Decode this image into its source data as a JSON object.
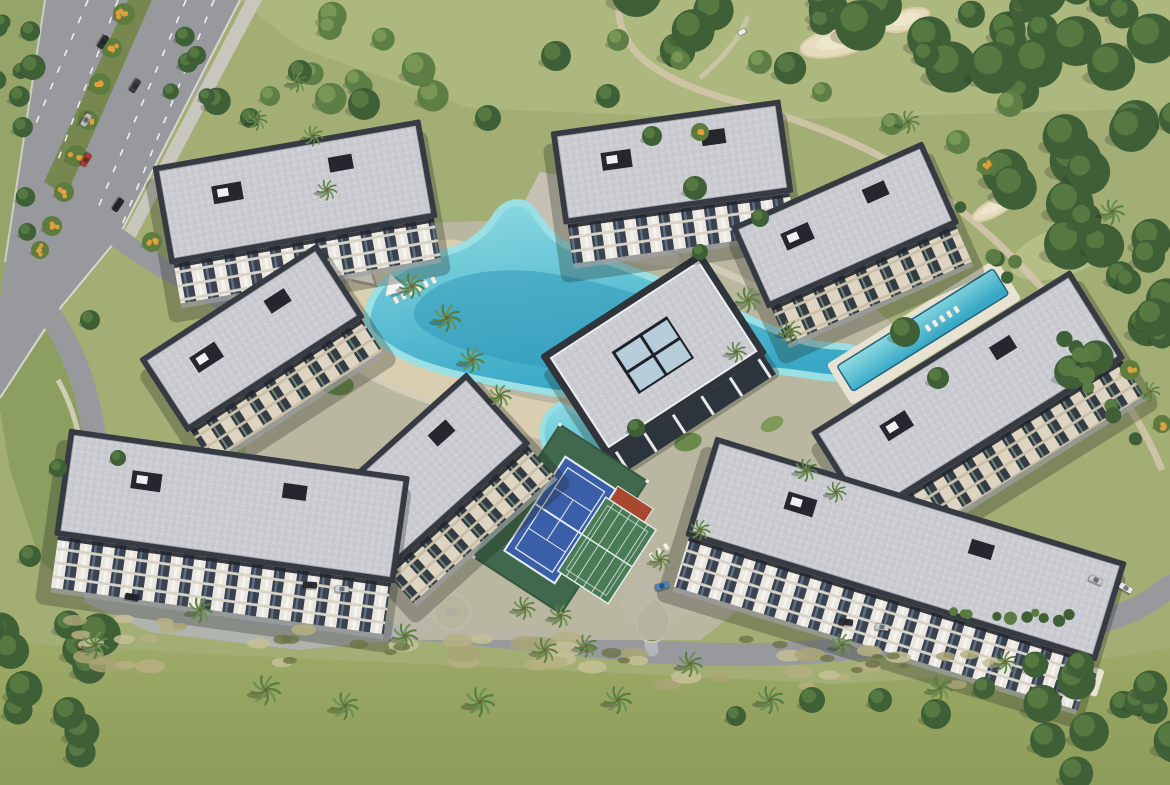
{
  "meta": {
    "title": "Aerial render of a residential apartment complex with lagoon pool, clubhouse, tennis courts and surrounding golf course",
    "view": "aerial-drone",
    "setting": "gated residential masterplan beside golf fairways and a tree-lined avenue"
  },
  "palette": {
    "base": "#a3ae75",
    "golfLight": "#adb87e",
    "fairway1": "#9daa68",
    "fairway2": "#8c9c59",
    "verge": "#95a468",
    "garden": "#8d9f60",
    "islandGreen": "#76904f",
    "forest1": "#3f5f36",
    "forest2": "#66884a",
    "treeLight1": "#5d7f46",
    "treeLight2": "#8aa75e",
    "palm1": "#6c9153",
    "palm2": "#597e42",
    "flowerGreen": "#5e7c3e",
    "flowerOrange": "#e2a13c",
    "rough1": "#b6b081",
    "rough2": "#c6c095",
    "rough3": "#a9a475",
    "scrub": "#6e7246",
    "asphalt": "#97999d",
    "roadLight": "#b3b5b9",
    "pavement": "#c6c1b2",
    "sidewalk": "#c9c6bd",
    "pathBeige": "#cfc5a9",
    "curb": "#e3e3df",
    "median": "#76874f",
    "parapet": "#363a42",
    "parapetDark": "#24272d",
    "gravel1": "#cbccd1",
    "gravel2": "#bdbfc5",
    "gravel3": "#d7d8db",
    "facadeLight": "#ebe8e1",
    "facadeCream": "#ddd4c2",
    "glassDark": "#3a4250",
    "slab": "#d8d2c6",
    "poolLight": "#8fdce2",
    "poolMid": "#38a8c6",
    "poolDeep": "#2e95b8",
    "poolRim": "#9adfe3",
    "poolEdge": "#23657f",
    "beach": "#dbcfb2",
    "deck": "#e8e2d2",
    "courtBlue": "#3b5ea8",
    "courtGreen": "#3f684d",
    "padelGreen": "#497b55",
    "courtRed": "#a8492f",
    "lineWhite": "#e6ebef",
    "skylight": "#b7cdd9",
    "stream": "#a6a793",
    "sand1": "#e6dcbd",
    "sand2": "#d9cda8",
    "shadow": "#1e2319",
    "white": "#f2efe6"
  },
  "scene": {
    "buildings": [
      {
        "id": "top-left",
        "cx": 295,
        "cy": 192,
        "w": 272,
        "h": 100,
        "rot": -10,
        "facade": "A",
        "fh": 40
      },
      {
        "id": "left",
        "cx": 252,
        "cy": 338,
        "w": 212,
        "h": 88,
        "rot": -33,
        "facade": "B",
        "fh": 38
      },
      {
        "id": "top-center",
        "cx": 672,
        "cy": 162,
        "w": 232,
        "h": 94,
        "rot": -8,
        "facade": "A",
        "fh": 40
      },
      {
        "id": "top-right",
        "cx": 845,
        "cy": 225,
        "w": 210,
        "h": 90,
        "rot": -24,
        "facade": "B",
        "fh": 40
      },
      {
        "id": "right",
        "cx": 968,
        "cy": 395,
        "w": 306,
        "h": 104,
        "rot": -32,
        "facade": "B",
        "fh": 42
      },
      {
        "id": "bottom-right",
        "cx": 906,
        "cy": 549,
        "w": 430,
        "h": 104,
        "rot": 17,
        "facade": "A",
        "fh": 52
      },
      {
        "id": "bottom-left",
        "cx": 232,
        "cy": 506,
        "w": 344,
        "h": 108,
        "rot": 8,
        "facade": "A",
        "fh": 52
      },
      {
        "id": "bottom-left-wing",
        "cx": 425,
        "cy": 474,
        "w": 198,
        "h": 96,
        "rot": -42,
        "facade": "B",
        "fh": 40
      }
    ],
    "forestClusters": [
      {
        "cx": 900,
        "cy": 28,
        "rx": 270,
        "ry": 42,
        "n": 26,
        "rmin": 13,
        "rmax": 26,
        "type": "forest",
        "seed": 7
      },
      {
        "cx": 1085,
        "cy": 165,
        "rx": 95,
        "ry": 115,
        "n": 18,
        "rmin": 15,
        "rmax": 28,
        "type": "forest",
        "seed": 11
      },
      {
        "cx": 1122,
        "cy": 330,
        "rx": 60,
        "ry": 80,
        "n": 10,
        "rmin": 12,
        "rmax": 22,
        "type": "forest",
        "seed": 3
      },
      {
        "cx": 1048,
        "cy": 322,
        "rx": 150,
        "ry": 10,
        "rot": 55,
        "n": 16,
        "rmin": 5,
        "rmax": 9,
        "type": "hedge",
        "seed": 5
      },
      {
        "cx": 1005,
        "cy": 612,
        "rx": 85,
        "ry": 7,
        "rot": 6,
        "n": 10,
        "rmin": 4,
        "rmax": 7,
        "type": "hedge",
        "seed": 9
      },
      {
        "cx": 1112,
        "cy": 722,
        "rx": 85,
        "ry": 62,
        "n": 12,
        "rmin": 13,
        "rmax": 24,
        "type": "forest",
        "seed": 13
      },
      {
        "cx": 52,
        "cy": 702,
        "rx": 78,
        "ry": 85,
        "n": 12,
        "rmin": 12,
        "rmax": 22,
        "type": "forest",
        "seed": 17
      },
      {
        "cx": 16,
        "cy": 120,
        "rx": 22,
        "ry": 115,
        "n": 10,
        "rmin": 7,
        "rmax": 13,
        "type": "forest",
        "seed": 19
      },
      {
        "cx": 430,
        "cy": 55,
        "rx": 120,
        "ry": 45,
        "n": 9,
        "rmin": 10,
        "rmax": 17,
        "type": "light",
        "seed": 23
      },
      {
        "cx": 208,
        "cy": 75,
        "rx": 40,
        "ry": 55,
        "n": 6,
        "rmin": 8,
        "rmax": 14,
        "type": "forest",
        "seed": 29
      },
      {
        "cx": 360,
        "cy": 648,
        "rx": 300,
        "ry": 20,
        "n": 26,
        "rmin": 8,
        "rmax": 18,
        "type": "rough",
        "seed": 31
      },
      {
        "cx": 800,
        "cy": 668,
        "rx": 205,
        "ry": 18,
        "n": 16,
        "rmin": 8,
        "rmax": 16,
        "type": "rough",
        "seed": 37
      },
      {
        "cx": 118,
        "cy": 628,
        "rx": 75,
        "ry": 16,
        "n": 8,
        "rmin": 7,
        "rmax": 14,
        "type": "rough",
        "seed": 41
      },
      {
        "cx": 520,
        "cy": 650,
        "rx": 260,
        "ry": 12,
        "n": 11,
        "rmin": 5,
        "rmax": 10,
        "type": "scrub",
        "seed": 43
      },
      {
        "cx": 862,
        "cy": 664,
        "rx": 120,
        "ry": 10,
        "n": 6,
        "rmin": 5,
        "rmax": 9,
        "type": "scrub",
        "seed": 47
      }
    ],
    "forestSingles": [
      [
        364,
        104,
        16
      ],
      [
        300,
        72,
        12
      ],
      [
        488,
        118,
        13
      ],
      [
        556,
        56,
        15
      ],
      [
        608,
        96,
        12
      ],
      [
        652,
        136,
        10
      ],
      [
        695,
        188,
        12
      ],
      [
        905,
        332,
        15
      ],
      [
        938,
        378,
        11
      ],
      [
        250,
        118,
        10
      ],
      [
        90,
        320,
        10
      ],
      [
        58,
        468,
        9
      ],
      [
        118,
        458,
        8
      ],
      [
        30,
        556,
        11
      ],
      [
        636,
        428,
        9
      ],
      [
        760,
        218,
        9
      ],
      [
        700,
        252,
        8
      ],
      [
        812,
        700,
        13
      ],
      [
        936,
        714,
        15
      ],
      [
        984,
        688,
        11
      ],
      [
        880,
        700,
        12
      ],
      [
        736,
        716,
        10
      ]
    ],
    "lightSingles": [
      [
        330,
        28,
        12
      ],
      [
        270,
        96,
        10
      ],
      [
        760,
        62,
        12
      ],
      [
        822,
        92,
        10
      ],
      [
        892,
        124,
        11
      ],
      [
        958,
        142,
        12
      ],
      [
        1010,
        104,
        13
      ],
      [
        618,
        40,
        11
      ],
      [
        680,
        60,
        10
      ]
    ],
    "palms": [
      [
        412,
        286,
        1.1
      ],
      [
        447,
        318,
        1.2
      ],
      [
        472,
        360,
        1.1
      ],
      [
        500,
        396,
        1.0
      ],
      [
        748,
        300,
        1.1
      ],
      [
        790,
        332,
        1.0
      ],
      [
        736,
        352,
        0.9
      ],
      [
        524,
        608,
        1.0
      ],
      [
        560,
        616,
        1.0
      ],
      [
        806,
        470,
        1.0
      ],
      [
        836,
        492,
        0.9
      ],
      [
        95,
        645,
        1.2
      ],
      [
        200,
        610,
        1.1
      ],
      [
        266,
        690,
        1.3
      ],
      [
        345,
        706,
        1.2
      ],
      [
        405,
        636,
        1.1
      ],
      [
        480,
        702,
        1.3
      ],
      [
        545,
        650,
        1.1
      ],
      [
        618,
        700,
        1.2
      ],
      [
        690,
        664,
        1.1
      ],
      [
        770,
        700,
        1.2
      ],
      [
        842,
        645,
        1.0
      ],
      [
        940,
        688,
        1.1
      ],
      [
        1005,
        662,
        1.0
      ],
      [
        297,
        82,
        0.9
      ],
      [
        313,
        136,
        0.9
      ],
      [
        327,
        190,
        0.9
      ],
      [
        257,
        120,
        0.9
      ],
      [
        908,
        122,
        1.0
      ],
      [
        1112,
        212,
        1.1
      ],
      [
        1150,
        392,
        0.9
      ],
      [
        700,
        530,
        0.9
      ],
      [
        660,
        560,
        0.9
      ],
      [
        586,
        646,
        1.0
      ]
    ],
    "flowering": [
      [
        124,
        14,
        11
      ],
      [
        112,
        48,
        10
      ],
      [
        100,
        84,
        11
      ],
      [
        88,
        120,
        10
      ],
      [
        76,
        156,
        11
      ],
      [
        64,
        192,
        10
      ],
      [
        52,
        226,
        10
      ],
      [
        152,
        242,
        10
      ],
      [
        986,
        166,
        9
      ],
      [
        1130,
        370,
        10
      ],
      [
        1162,
        424,
        9
      ],
      [
        700,
        132,
        9
      ],
      [
        40,
        250,
        9
      ]
    ],
    "bunkers": [
      {
        "x": 838,
        "y": 42,
        "rx": 38,
        "ry": 14,
        "rot": -12
      },
      {
        "x": 906,
        "y": 20,
        "rx": 24,
        "ry": 10,
        "rot": -18
      },
      {
        "x": 994,
        "y": 208,
        "rx": 24,
        "ry": 8,
        "rot": -28
      }
    ],
    "cars": [
      {
        "x": 103,
        "y": 42,
        "rot": 122,
        "c": "#2b2e33"
      },
      {
        "x": 86,
        "y": 120,
        "rot": 122,
        "c": "#b8babd"
      },
      {
        "x": 135,
        "y": 86,
        "rot": 122,
        "c": "#3a3d42"
      },
      {
        "x": 86,
        "y": 160,
        "rot": 122,
        "c": "#b03a32"
      },
      {
        "x": 118,
        "y": 205,
        "rot": 124,
        "c": "#23262b"
      },
      {
        "x": 310,
        "y": 585,
        "rot": 4,
        "c": "#2c2f34"
      },
      {
        "x": 342,
        "y": 589,
        "rot": 4,
        "c": "#cfd2d6"
      },
      {
        "x": 132,
        "y": 597,
        "rot": 10,
        "c": "#23262b"
      },
      {
        "x": 662,
        "y": 586,
        "rot": -15,
        "c": "#4f86c0"
      },
      {
        "x": 846,
        "y": 622,
        "rot": 7,
        "c": "#2c2f34"
      },
      {
        "x": 882,
        "y": 627,
        "rot": 7,
        "c": "#c9ccd0"
      },
      {
        "x": 1096,
        "y": 580,
        "rot": 24,
        "c": "#c6c9cd"
      },
      {
        "x": 1126,
        "y": 588,
        "rot": 30,
        "c": "#e4e5e7"
      }
    ],
    "loungerRows": [
      {
        "x": 396,
        "y": 300,
        "rot": -28,
        "n": 6
      },
      {
        "x": 928,
        "y": 328,
        "rot": -33,
        "n": 5
      },
      {
        "x": 610,
        "y": 474,
        "rot": -30,
        "n": 4
      },
      {
        "x": 348,
        "y": 262,
        "rot": -25,
        "n": 4
      },
      {
        "x": 652,
        "y": 556,
        "rot": -33,
        "n": 3
      }
    ],
    "sails": [
      {
        "x": 362,
        "y": 272,
        "s": 26,
        "rot": 10
      },
      {
        "x": 394,
        "y": 286,
        "s": 21,
        "rot": -18
      },
      {
        "x": 668,
        "y": 240,
        "s": 24,
        "rot": 14
      }
    ],
    "greenPatches": [
      {
        "x": 302,
        "y": 322,
        "rx": 24,
        "ry": 14,
        "rot": -20
      },
      {
        "x": 336,
        "y": 384,
        "rx": 18,
        "ry": 11,
        "rot": 10
      },
      {
        "x": 436,
        "y": 420,
        "rx": 16,
        "ry": 9,
        "rot": 0
      },
      {
        "x": 688,
        "y": 442,
        "rx": 14,
        "ry": 9,
        "rot": -15
      },
      {
        "x": 722,
        "y": 472,
        "rx": 11,
        "ry": 7,
        "rot": 0
      },
      {
        "x": 586,
        "y": 214,
        "rx": 14,
        "ry": 8,
        "rot": 8
      },
      {
        "x": 654,
        "y": 214,
        "rx": 10,
        "ry": 6,
        "rot": 0
      },
      {
        "x": 284,
        "y": 360,
        "rx": 12,
        "ry": 8,
        "rot": -30
      },
      {
        "x": 772,
        "y": 424,
        "rx": 12,
        "ry": 7,
        "rot": -25
      },
      {
        "x": 508,
        "y": 434,
        "rx": 10,
        "ry": 6,
        "rot": 0
      }
    ]
  }
}
